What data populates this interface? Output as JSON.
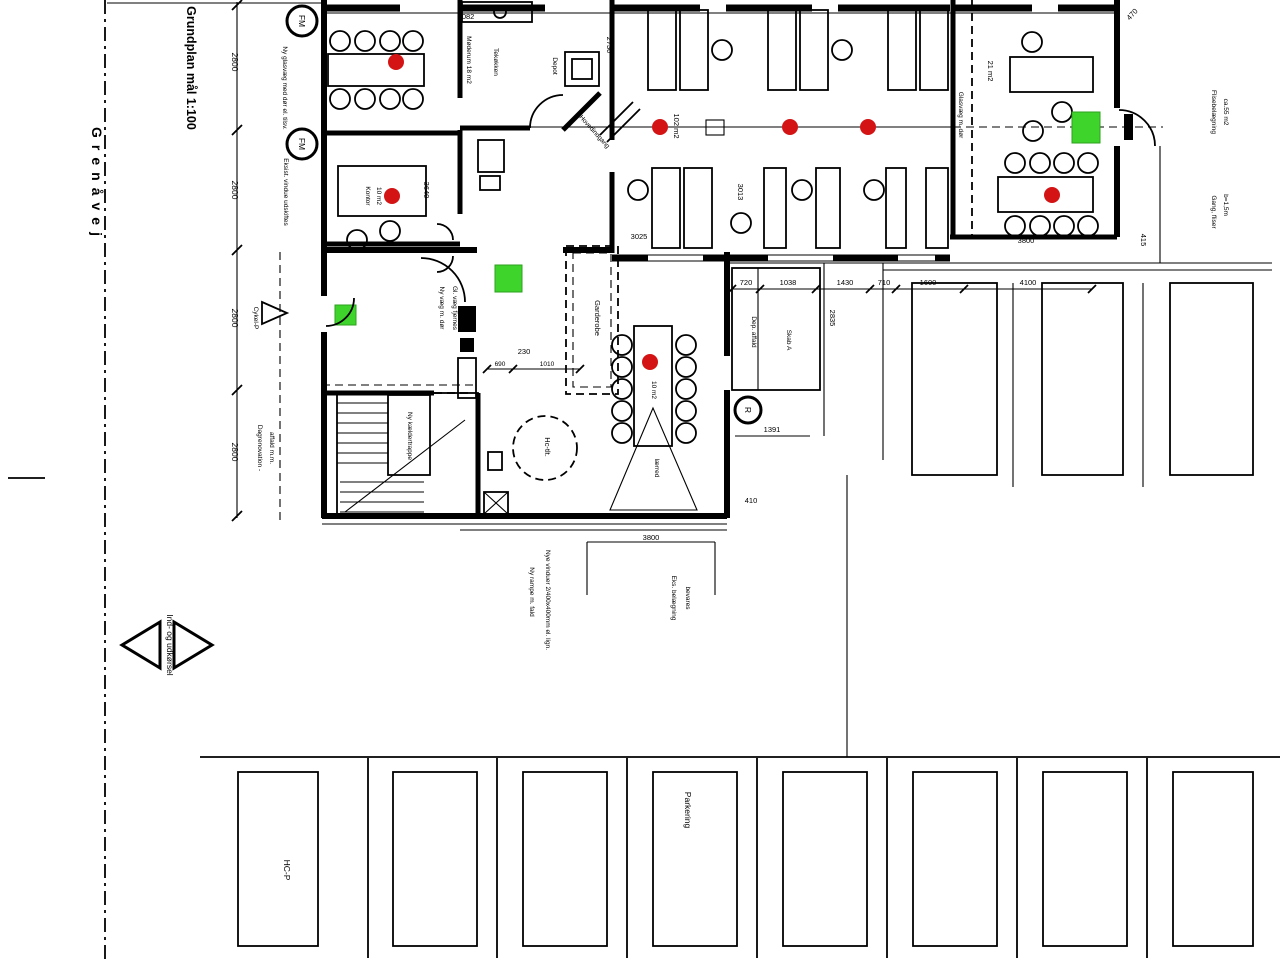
{
  "colors": {
    "background": "#ffffff",
    "ink": "#000000",
    "marker_red": "#d41414",
    "marker_green": "#3fd42c"
  },
  "title": {
    "plan": "Grundplan mål 1:100",
    "street": "Grenåvej"
  },
  "rooms": {
    "meeting_tl": "Møderum 18 m2",
    "office_small_1": "Kontor",
    "office_small_2": "10 m2",
    "kitchen": "Tekøkken",
    "depot": "Depot",
    "open_office": "102 m2",
    "table_note": "10 m2",
    "room_right": "21 m2",
    "wardrobe": "Garderobe",
    "hc_toilet": "Hc-tlt.",
    "stairs": "Ny kældertrappe",
    "screen": "lærred",
    "shed_a": "Dep. affald",
    "shed_b": "Skab A"
  },
  "annotations": {
    "glass_wall_top": "Ny glasvæg med dør el. tilsv.",
    "window_top": "Eksist. vindue udskiftes",
    "fm_symbol": "FM",
    "r_symbol": "R",
    "paving_right_1": "Flisebelægning",
    "paving_right_2": "ca.55 m2",
    "path_right_1": "Gang, fliser",
    "path_right_2": "b=1,5m",
    "glass_wall_right": "Glasvæg m. dør",
    "entrance_diag": "Hovedindgang",
    "bike": "Cykel-P",
    "waste_1": "Dagrenovation -",
    "waste_2": "affald m.m.",
    "wall_note_a": "Ny væg m. dør",
    "wall_note_b": "Gl. væg fjernes",
    "south_note_a1": "Ny rampe m. fald",
    "south_note_a2": "Nye vinduer 2/400x400mm el. lign.",
    "south_note_b1": "Eks. belægning",
    "south_note_b2": "bevares",
    "in_out": "Ind- og udkørsel"
  },
  "dimensions": {
    "left_chain": [
      "2800",
      "2800",
      "2800",
      "2800"
    ],
    "top_wall": "5082",
    "kitchen_height": "2730",
    "office_width": "3640",
    "open_office_w": "3025",
    "open_office_h": "3013",
    "corridor_chain": [
      "720",
      "1038",
      "1430",
      "710",
      "1600",
      "4100"
    ],
    "shed_width": "1391",
    "shed_height": "2835",
    "niche": "230",
    "niche_a": "690",
    "niche_b": "1010",
    "wing_south": "3800",
    "right_room_south": "3800",
    "right_edge": "415",
    "top_right_diag": "470",
    "misc": "410"
  },
  "parking": {
    "hc_stall": "HC-P",
    "stall_label": "Parkering"
  }
}
